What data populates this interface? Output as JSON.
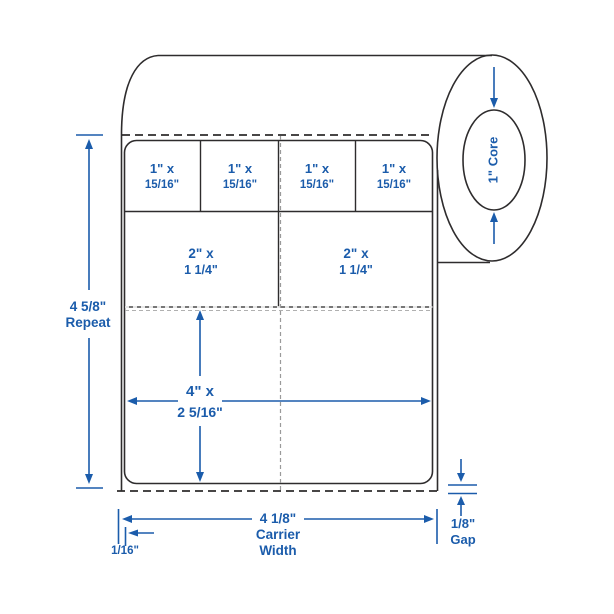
{
  "colors": {
    "accent_blue": "#1b5cab",
    "line_dark": "#2e2c2d",
    "perforation_gray": "#9a9a9a"
  },
  "roll": {
    "core_label": "1\" Core"
  },
  "labels": {
    "small": [
      {
        "line1": "1\" x",
        "line2": "15/16\""
      },
      {
        "line1": "1\" x",
        "line2": "15/16\""
      },
      {
        "line1": "1\" x",
        "line2": "15/16\""
      },
      {
        "line1": "1\" x",
        "line2": "15/16\""
      }
    ],
    "medium": [
      {
        "line1": "2\" x",
        "line2": "1 1/4\""
      },
      {
        "line1": "2\" x",
        "line2": "1 1/4\""
      }
    ],
    "large": {
      "line1": "4\" x",
      "line2": "2 5/16\""
    }
  },
  "dimensions": {
    "repeat": {
      "line1": "4 5/8\"",
      "line2": "Repeat"
    },
    "carrier_width": {
      "line1": "4 1/8\"",
      "line2": "Carrier",
      "line3": "Width"
    },
    "left_margin": {
      "line1": "1/16\""
    },
    "gap": {
      "line1": "1/8\"",
      "line2": "Gap"
    }
  }
}
